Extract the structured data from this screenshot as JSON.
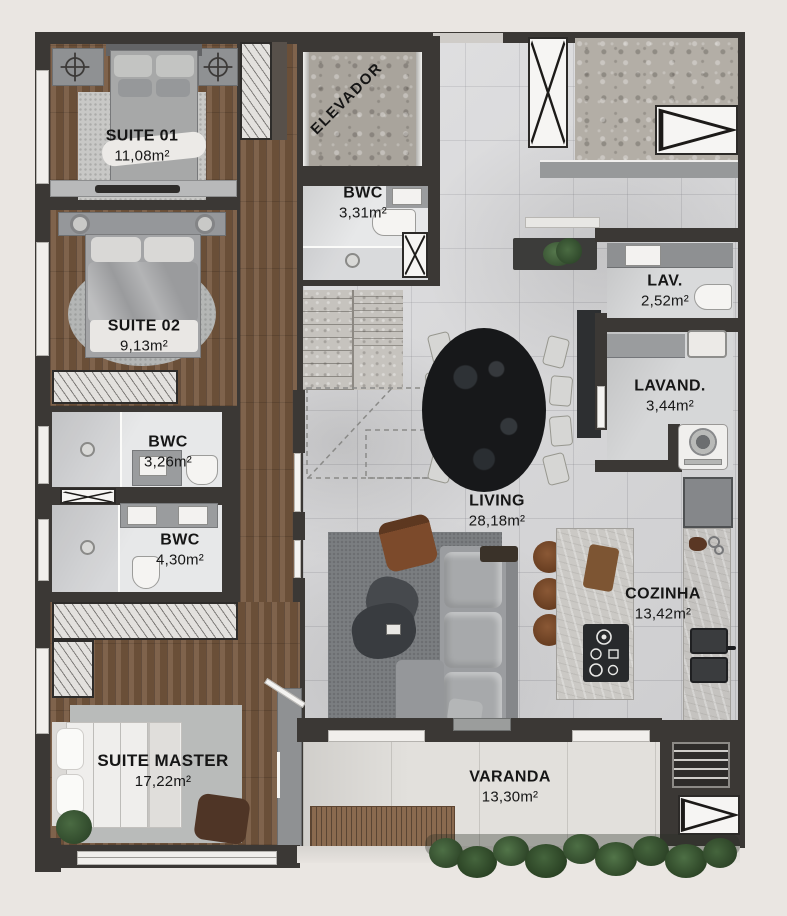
{
  "plan_title": "apartment-floor-plan",
  "rooms": {
    "suite01": {
      "name": "SUITE 01",
      "area": "11,08m²"
    },
    "suite02": {
      "name": "SUITE 02",
      "area": "9,13m²"
    },
    "suite_master": {
      "name": "SUITE MASTER",
      "area": "17,22m²"
    },
    "bwc_social": {
      "name": "BWC",
      "area": "3,31m²"
    },
    "bwc_suite02": {
      "name": "BWC",
      "area": "3,26m²"
    },
    "bwc_master": {
      "name": "BWC",
      "area": "4,30m²"
    },
    "living": {
      "name": "LIVING",
      "area": "28,18m²"
    },
    "cozinha": {
      "name": "COZINHA",
      "area": "13,42m²"
    },
    "lav": {
      "name": "LAV.",
      "area": "2,52m²"
    },
    "lavand": {
      "name": "LAVAND.",
      "area": "3,44m²"
    },
    "varanda": {
      "name": "VARANDA",
      "area": "13,30m²"
    },
    "elevador": {
      "name": "ELEVADOR"
    }
  },
  "colors": {
    "background": "#eae6e2",
    "wall": "#3b3835",
    "wood_floor": "#75573e",
    "tile_floor": "#d8d8da",
    "balcony_floor": "#e2e0dc",
    "stone_counter": "#cbc9c5",
    "granite": "#a9a49c",
    "rug_dark": "#7b7e81",
    "rug_light": "#b9bbba",
    "sofa_gray": "#9b9da0",
    "dining_table": "#1b1d1f",
    "leather_brown": "#7a4a2b",
    "plant_green": "#3f5c38",
    "deck_wood": "#8a6a4f",
    "label_text": "#161616"
  }
}
